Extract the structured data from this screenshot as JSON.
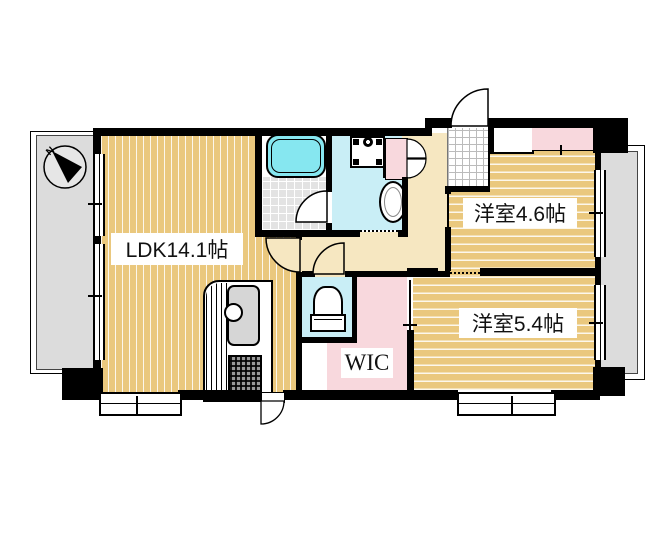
{
  "floorplan": {
    "type": "japanese-apartment-floorplan",
    "rooms": {
      "ldk": {
        "label": "LDK14.1帖"
      },
      "bedroom1": {
        "label": "洋室4.6帖"
      },
      "bedroom2": {
        "label": "洋室5.4帖"
      },
      "wic": {
        "label": "WIC"
      }
    },
    "compass": {
      "label": "N"
    },
    "palette": {
      "wall": "#000000",
      "room_floor": "#EAC87E",
      "hallway_floor": "#F6E7C1",
      "wet_area": "#C9EEF6",
      "closet_pink": "#F8D8DD",
      "balcony_gray": "#DCDCDC",
      "bathtub_cyan": "#86E7F0",
      "tile_gray": "#E3E3E3"
    },
    "icons": {
      "compass": "circle-with-black-needle",
      "bathtub": "rounded-rect-tub",
      "washing_machine": "square-with-corner-pads-and-drum",
      "washbasin": "oval-basin",
      "toilet": "bowl-with-tank",
      "kitchen_sink": "gray-rounded-sink-with-faucet",
      "stove": "hatched-grill",
      "door_swing": "quarter-arc",
      "double_closet_doors": "butterfly-arcs",
      "window": "double-line-strip"
    }
  }
}
